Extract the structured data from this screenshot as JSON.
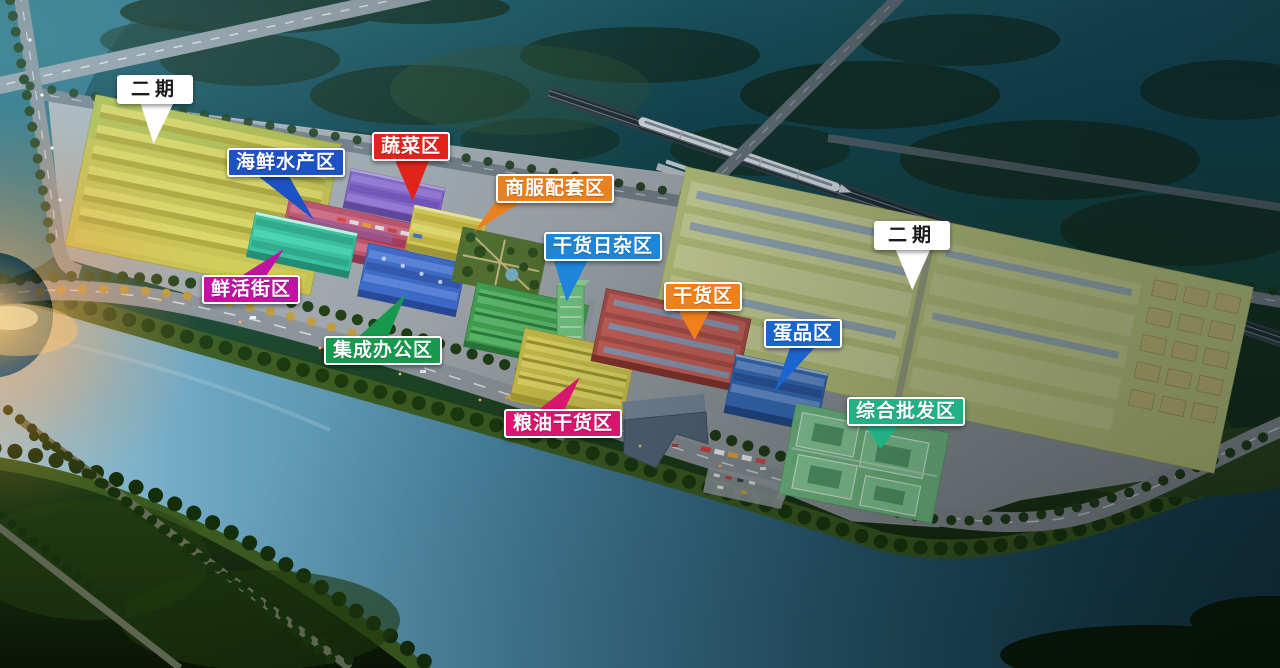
{
  "labels": {
    "phase2_left": {
      "text": "二期",
      "bg": "#ffffff",
      "fg": "#1a1a1a"
    },
    "seafood": {
      "text": "海鲜水产区",
      "bg": "#1d52c4",
      "fg": "#ffffff"
    },
    "vegetable": {
      "text": "蔬菜区",
      "bg": "#e0241c",
      "fg": "#ffffff"
    },
    "commercial": {
      "text": "商服配套区",
      "bg": "#e9811f",
      "fg": "#ffffff"
    },
    "sundries": {
      "text": "干货日杂区",
      "bg": "#1e86d8",
      "fg": "#ffffff"
    },
    "drygoods": {
      "text": "干货区",
      "bg": "#f0801a",
      "fg": "#ffffff"
    },
    "eggs": {
      "text": "蛋品区",
      "bg": "#1b66cc",
      "fg": "#ffffff"
    },
    "fresh_street": {
      "text": "鲜活街区",
      "bg": "#c013a4",
      "fg": "#ffffff"
    },
    "office": {
      "text": "集成办公区",
      "bg": "#17994e",
      "fg": "#ffffff"
    },
    "grain_oil": {
      "text": "粮油干货区",
      "bg": "#d8156f",
      "fg": "#ffffff"
    },
    "wholesale": {
      "text": "综合批发区",
      "bg": "#21b185",
      "fg": "#ffffff"
    },
    "phase2_right": {
      "text": "二期",
      "bg": "#ffffff",
      "fg": "#1a1a1a"
    }
  },
  "zones": {
    "phase2_left": {
      "color": "#ccc34b"
    },
    "phase2_right": {
      "color": "#c6cf82"
    },
    "vegetable": {
      "color": "#8a64cf"
    },
    "seafood": {
      "color": "#c6506a"
    },
    "fresh_street": {
      "color": "#35c59d"
    },
    "office": {
      "color": "#3e6ccd"
    },
    "commercial": {
      "color": "#e3d254"
    },
    "sundries": {
      "color": "#45a552"
    },
    "grain_oil": {
      "color": "#d2c74d"
    },
    "drygoods": {
      "color": "#b5524c"
    },
    "eggs": {
      "color": "#3a74c8"
    },
    "wholesale": {
      "color": "#7bcd8d"
    }
  },
  "scene": {
    "river_color": "#47839f",
    "train_color": "#eef2f5",
    "sunset_glow_color": "#ffb759"
  }
}
